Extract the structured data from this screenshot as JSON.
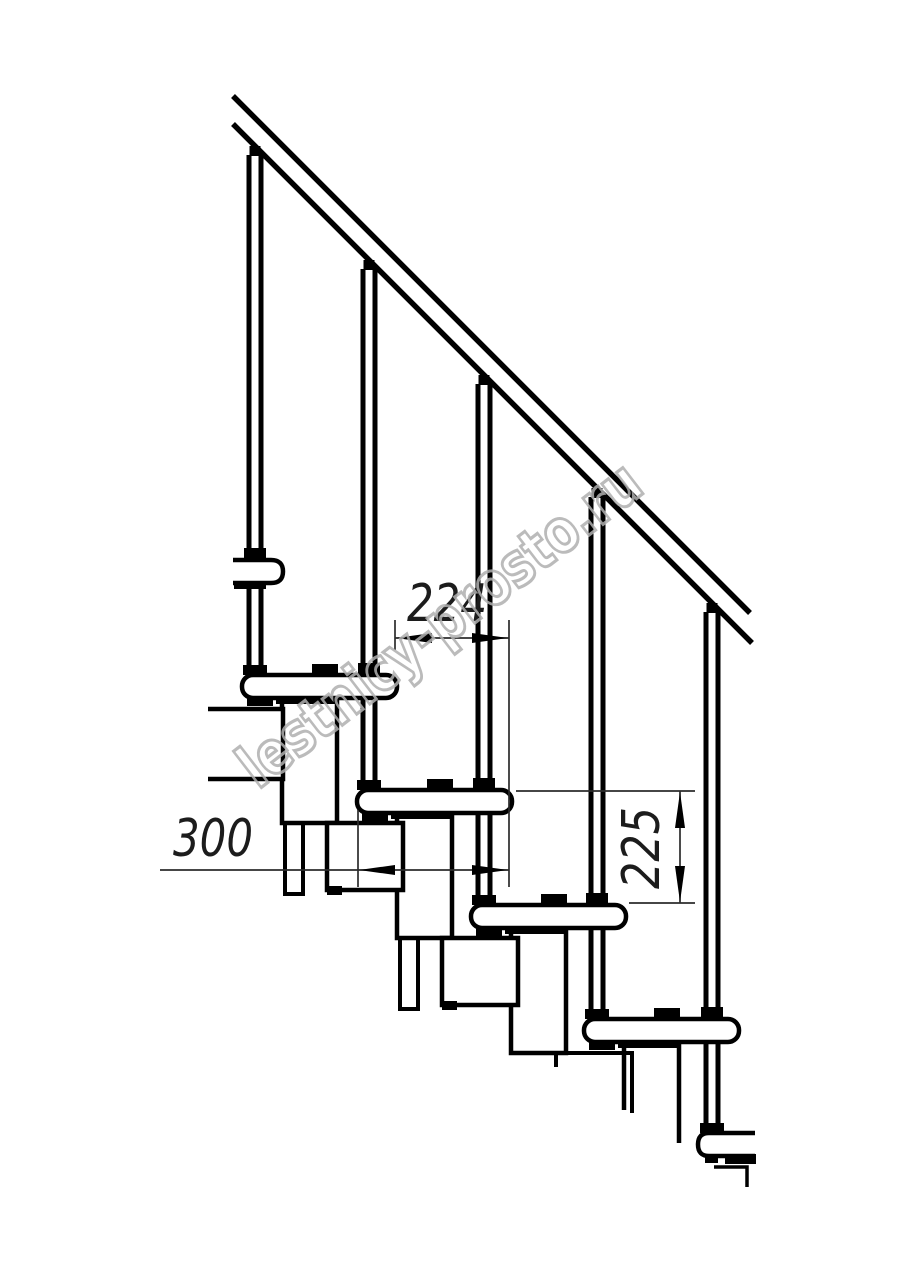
{
  "drawing": {
    "dimensions": {
      "tread_run": "224",
      "tread_depth": "300",
      "riser_height": "225"
    },
    "watermark": "lestnicy-prosto.ru",
    "colors": {
      "line": "#000000",
      "dimension_line": "#2b2b2b",
      "dimension_text": "#1c1c1c",
      "watermark": "#b0b0b0",
      "background": "#ffffff"
    }
  }
}
